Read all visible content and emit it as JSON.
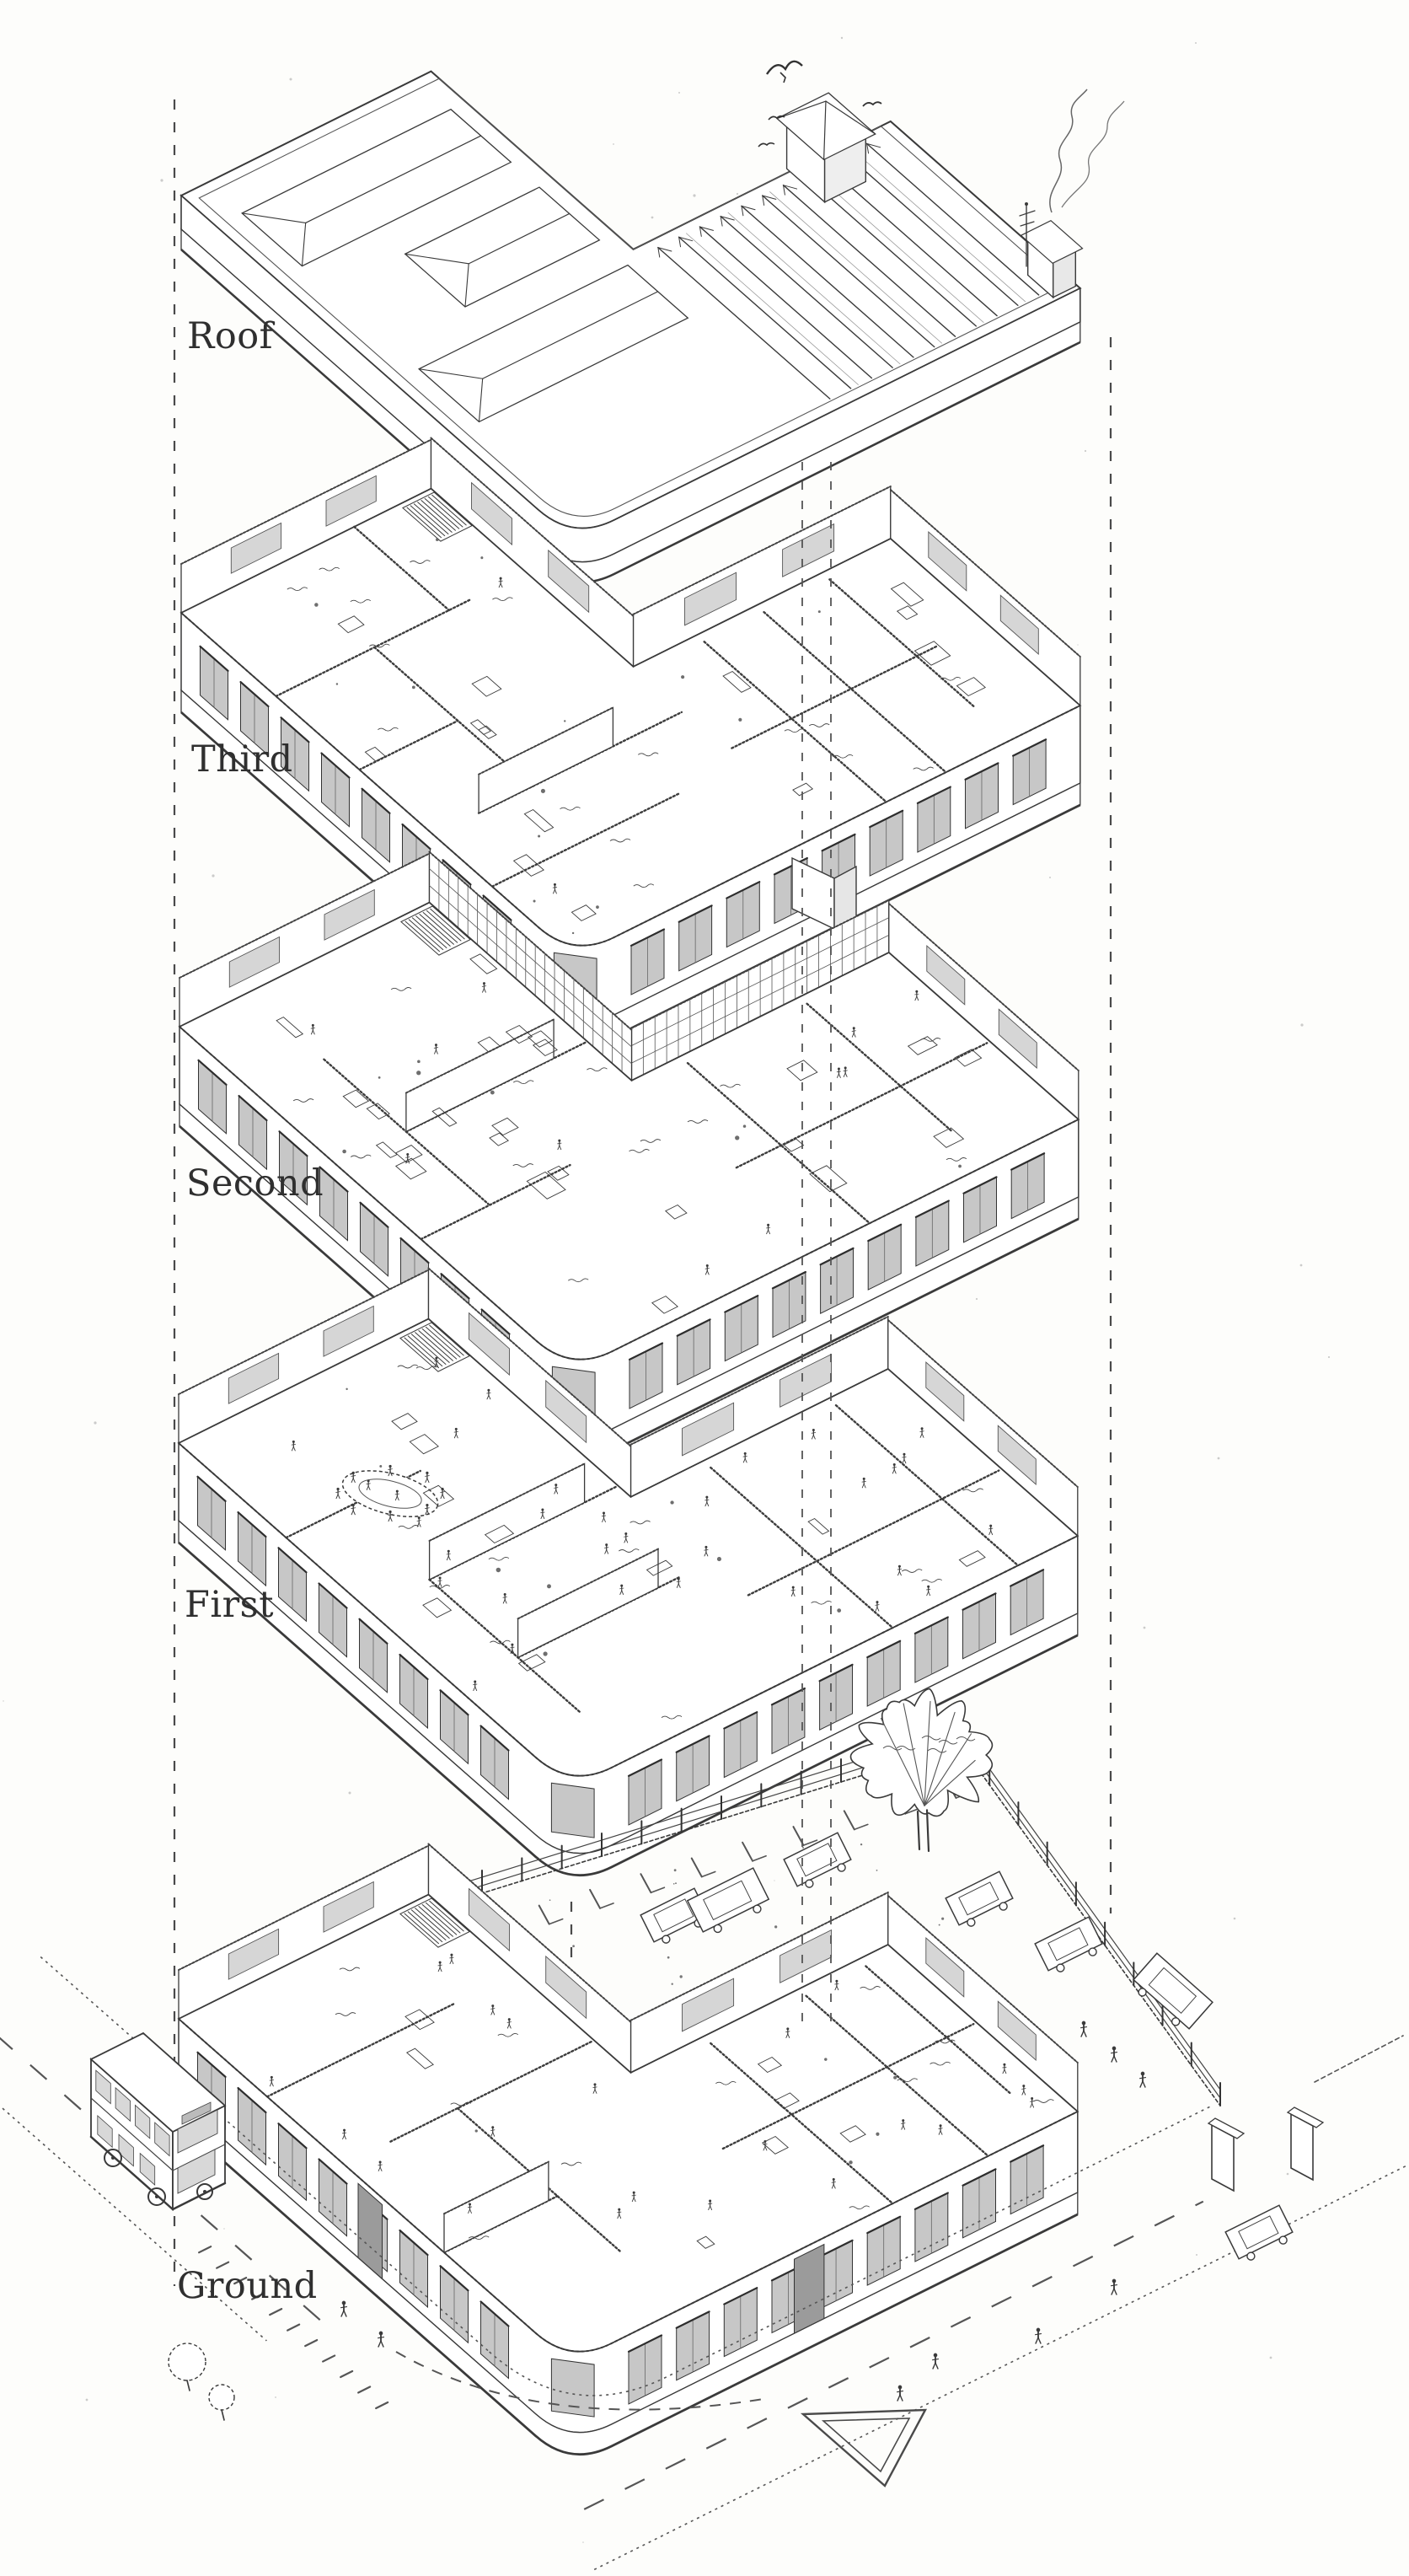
{
  "figure": {
    "type": "exploded axonometric line drawing",
    "medium": "black ink on white paper",
    "subject": "corner building separated into floor plates stacked vertically",
    "paper_color": "#fdfdfb",
    "ink_color": "#3a3a3a",
    "levels": [
      {
        "id": "roof",
        "label": "Roof"
      },
      {
        "id": "third",
        "label": "Third"
      },
      {
        "id": "second",
        "label": "Second"
      },
      {
        "id": "first",
        "label": "First"
      },
      {
        "id": "ground",
        "label": "Ground"
      }
    ],
    "scene_objects": [
      "dashed-projection-lines",
      "birds",
      "chimney",
      "chimney-smoke",
      "roof-lights",
      "stairs",
      "office-furniture",
      "crowds-of-people",
      "circular-bar",
      "double-decker-bus",
      "street-car",
      "parked-cars",
      "tree",
      "shrubs",
      "boundary-fence",
      "gate-piers",
      "parking-bay-marks",
      "road-centre-dashes",
      "give-way-triangle",
      "pedestrians"
    ]
  }
}
